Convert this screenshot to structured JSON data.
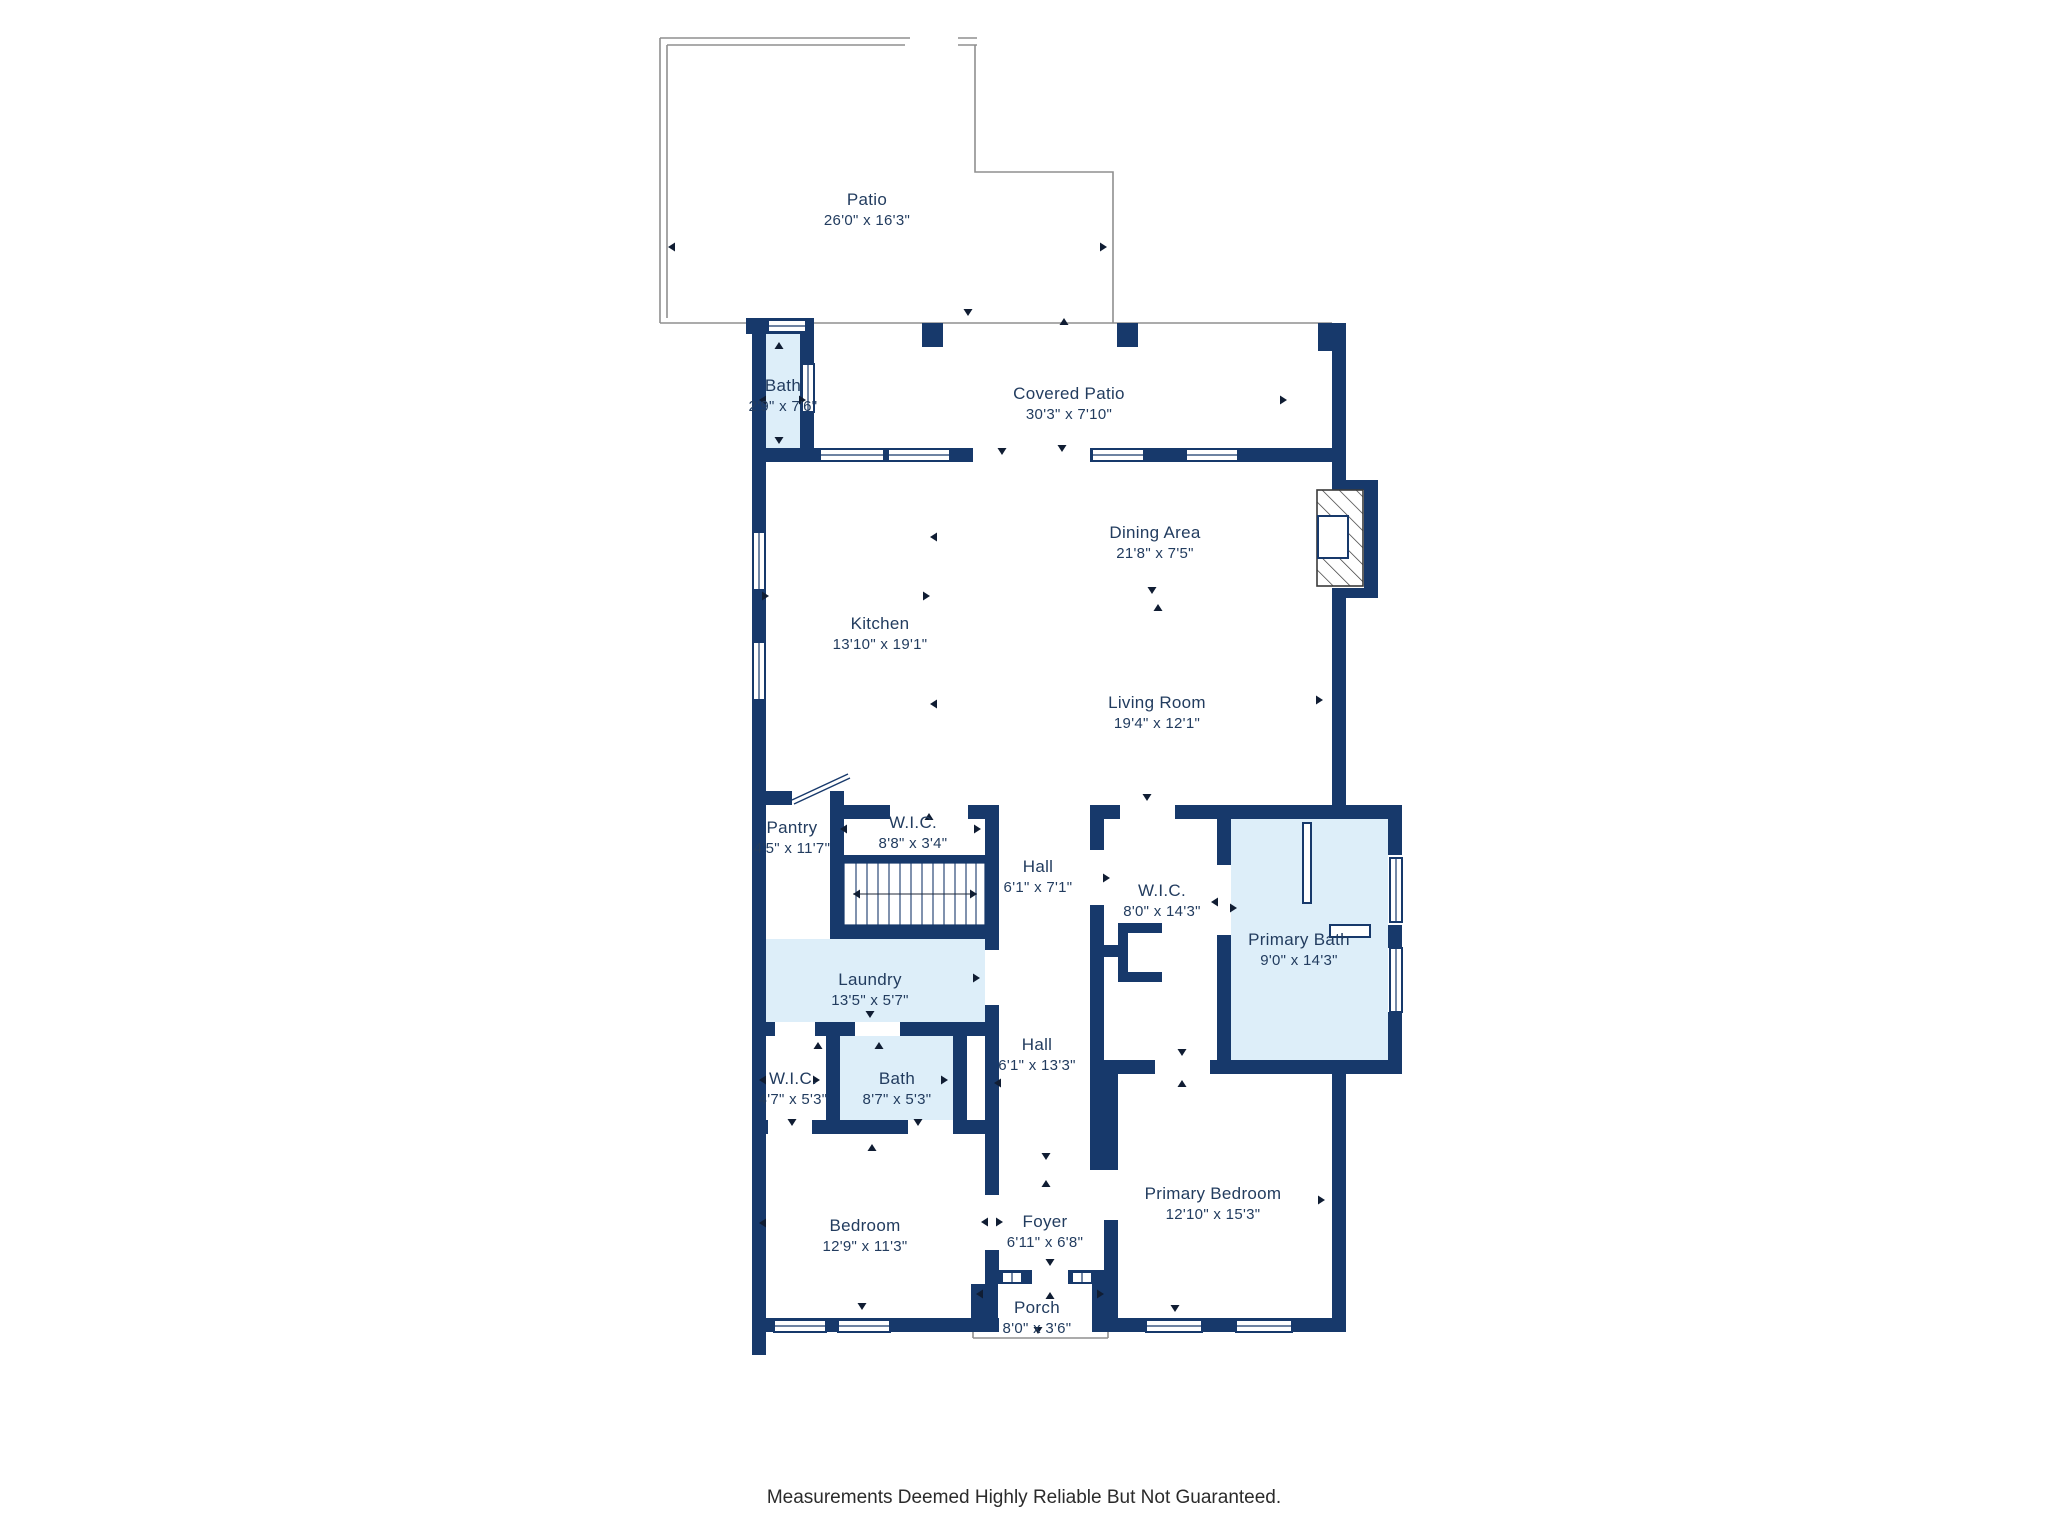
{
  "colors": {
    "wall": "#17396b",
    "room-fill": "#ddeef9",
    "outline": "#8f8f8f",
    "label": "#223c5f",
    "text": "#2b2b2b",
    "arrow": "#101d33"
  },
  "disclaimer": "Measurements Deemed Highly Reliable But Not Guaranteed.",
  "rooms": [
    {
      "id": "patio",
      "name": "Patio",
      "dims": "26'0\" x 16'3\""
    },
    {
      "id": "covered-patio",
      "name": "Covered Patio",
      "dims": "30'3\" x 7'10\""
    },
    {
      "id": "bath-top",
      "name": "Bath",
      "dims": "2'9\" x 7'6\""
    },
    {
      "id": "dining-area",
      "name": "Dining Area",
      "dims": "21'8\" x 7'5\""
    },
    {
      "id": "kitchen",
      "name": "Kitchen",
      "dims": "13'10\" x 19'1\""
    },
    {
      "id": "living-room",
      "name": "Living Room",
      "dims": "19'4\" x 12'1\""
    },
    {
      "id": "pantry",
      "name": "Pantry",
      "dims": "4'5\" x 11'7\""
    },
    {
      "id": "wic-kitchen",
      "name": "W.I.C.",
      "dims": "8'8\" x 3'4\""
    },
    {
      "id": "hall-upper",
      "name": "Hall",
      "dims": "6'1\" x 7'1\""
    },
    {
      "id": "wic-primary",
      "name": "W.I.C.",
      "dims": "8'0\" x 14'3\""
    },
    {
      "id": "primary-bath",
      "name": "Primary Bath",
      "dims": "9'0\" x 14'3\""
    },
    {
      "id": "laundry",
      "name": "Laundry",
      "dims": "13'5\" x 5'7\""
    },
    {
      "id": "wic-bedroom",
      "name": "W.I.C.",
      "dims": "4'7\" x 5'3\""
    },
    {
      "id": "bath-lower",
      "name": "Bath",
      "dims": "8'7\" x 5'3\""
    },
    {
      "id": "hall-lower",
      "name": "Hall",
      "dims": "6'1\" x 13'3\""
    },
    {
      "id": "bedroom",
      "name": "Bedroom",
      "dims": "12'9\" x 11'3\""
    },
    {
      "id": "foyer",
      "name": "Foyer",
      "dims": "6'11\" x 6'8\""
    },
    {
      "id": "primary-bedroom",
      "name": "Primary Bedroom",
      "dims": "12'10\" x 15'3\""
    },
    {
      "id": "porch",
      "name": "Porch",
      "dims": "8'0\" x 3'6\""
    }
  ]
}
